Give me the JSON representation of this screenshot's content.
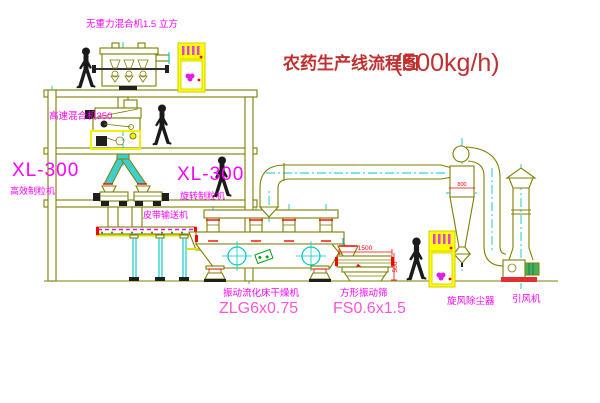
{
  "title": {
    "text": "农药生产线流程图",
    "capacity": "(500kg/h)"
  },
  "labels": {
    "gravity_mixer": "无重力混合机1.5 立方",
    "high_speed_mixer": "高速混合机350",
    "granulator_left_model": "XL-300",
    "granulator_left_name": "高效制粒机",
    "granulator_right_model": "XL-300",
    "granulator_right_name": "旋转制粒机",
    "belt_conveyor": "皮带输送机",
    "dryer_name": "振动流化床干燥机",
    "dryer_model": "ZLG6x0.75",
    "screen_name": "方形振动筛",
    "screen_model": "FS0.6x1.5",
    "cyclone": "旋风除尘器",
    "fan": "引风机"
  },
  "dimensions": {
    "screen_length": "1500",
    "screen_height": "500",
    "cyclone_body": "800"
  },
  "colors": {
    "line": "#7f7f00",
    "centerline": "#00c8c8",
    "label": "#ff00ff",
    "model_label": "#ff55d5",
    "title": "#c03030",
    "dimension": "#ff0000",
    "cabinet": "#ffff00",
    "figure": "#1a1a1a",
    "background": "#ffffff"
  }
}
